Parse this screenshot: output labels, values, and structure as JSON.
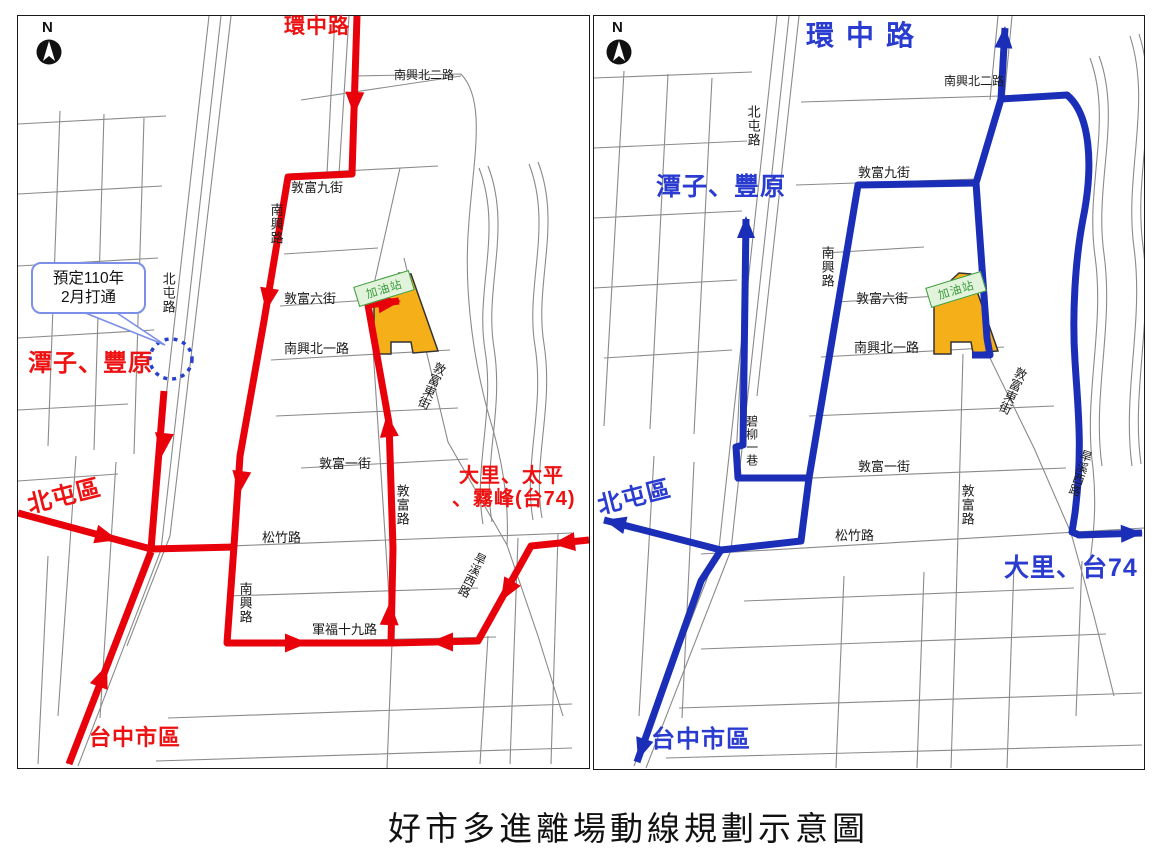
{
  "caption": "好市多進離場動線規劃示意圖",
  "compass_letter": "N",
  "callout": {
    "line1": "預定110年",
    "line2": "2月打通"
  },
  "gas_station_label": "加油站",
  "colors": {
    "entry_route": "#e8000b",
    "entry_text": "#ee1111",
    "exit_route": "#1b2eb8",
    "exit_text": "#2a3bd0",
    "site_fill": "#f5b019",
    "site_stroke": "#333333",
    "gas_fill": "#e2f3dc",
    "gas_stroke": "#3a9a3a",
    "callout_accent": "#7b8fe8",
    "dotted_circle": "#2741cd"
  },
  "left_map": {
    "street_labels": [
      {
        "t": "南興北二路",
        "x": 376,
        "y": 53,
        "fs": 12
      },
      {
        "t": "敦富九街",
        "x": 273,
        "y": 165,
        "fs": 13
      },
      {
        "t": "敦富六街",
        "x": 266,
        "y": 276,
        "fs": 13
      },
      {
        "t": "南興北一路",
        "x": 266,
        "y": 326,
        "fs": 13
      },
      {
        "t": "敦富一街",
        "x": 301,
        "y": 441,
        "fs": 13
      },
      {
        "t": "松竹路",
        "x": 244,
        "y": 515,
        "fs": 13
      },
      {
        "t": "軍福十九路",
        "x": 294,
        "y": 607,
        "fs": 13
      },
      {
        "t": "南興路",
        "x": 251,
        "y": 187,
        "fs": 13,
        "v": 1
      },
      {
        "t": "北屯路",
        "x": 143,
        "y": 256,
        "fs": 13,
        "v": 1
      },
      {
        "t": "敦富路",
        "x": 377,
        "y": 468,
        "fs": 13,
        "v": 1
      },
      {
        "t": "南興路",
        "x": 220,
        "y": 566,
        "fs": 13,
        "v": 1
      },
      {
        "t": "敦富東街",
        "x": 416,
        "y": 346,
        "fs": 12.5,
        "v": 1,
        "rot": 24
      },
      {
        "t": "旱溪西路",
        "x": 458,
        "y": 537,
        "fs": 12,
        "v": 1,
        "rot": 26
      }
    ],
    "region_labels": [
      {
        "t": "環中路",
        "x": 266,
        "y": 0,
        "fs": 21
      },
      {
        "t": "潭子、豐原",
        "x": 10,
        "y": 335,
        "fs": 24
      },
      {
        "t": "北屯區",
        "x": 9,
        "y": 468,
        "fs": 24,
        "rot": -14
      },
      {
        "t": "台中市區",
        "x": 71,
        "y": 710,
        "fs": 22
      },
      {
        "t": "大里、太平",
        "x": 441,
        "y": 450,
        "fs": 20
      },
      {
        "t": "、霧峰(台74)",
        "x": 434,
        "y": 473,
        "fs": 20
      }
    ],
    "routes": [
      {
        "d": "M339,0 L334,158 L270,161 L246,305 L222,440 L216,530 L209,627 L373,627 L375,532 L371,407 L350,289 L381,285",
        "arrows": [
          [
            336,
            99,
            92
          ],
          [
            248,
            295,
            99
          ],
          [
            221,
            478,
            97
          ],
          [
            290,
            627,
            0
          ],
          [
            372,
            586,
            -88
          ],
          [
            369,
            398,
            -96
          ],
          [
            383,
            285,
            -7
          ]
        ]
      },
      {
        "d": "M146,375 L133,533 L217,531",
        "arrows": [
          [
            144,
            440,
            96
          ]
        ]
      },
      {
        "d": "M0,497 L133,533",
        "arrows": [
          [
            100,
            524,
            15
          ]
        ]
      },
      {
        "d": "M51,748 L133,536",
        "arrows": [
          [
            89,
            649,
            -69
          ]
        ]
      },
      {
        "d": "M571,524 L513,530 L460,625 L374,627",
        "arrows": [
          [
            534,
            528,
            174
          ],
          [
            483,
            585,
            120
          ],
          [
            412,
            626,
            180
          ]
        ]
      }
    ]
  },
  "right_map": {
    "street_labels": [
      {
        "t": "南興北二路",
        "x": 350,
        "y": 59,
        "fs": 12
      },
      {
        "t": "敦富九街",
        "x": 264,
        "y": 150,
        "fs": 13
      },
      {
        "t": "敦富六街",
        "x": 262,
        "y": 276,
        "fs": 13
      },
      {
        "t": "南興北一路",
        "x": 260,
        "y": 325,
        "fs": 13
      },
      {
        "t": "敦富一街",
        "x": 264,
        "y": 444,
        "fs": 13
      },
      {
        "t": "松竹路",
        "x": 241,
        "y": 513,
        "fs": 13
      },
      {
        "t": "北屯路",
        "x": 152,
        "y": 89,
        "fs": 13,
        "v": 1
      },
      {
        "t": "南興路",
        "x": 226,
        "y": 230,
        "fs": 13,
        "v": 1
      },
      {
        "t": "碧柳一巷",
        "x": 151,
        "y": 399,
        "fs": 12,
        "v": 1
      },
      {
        "t": "敦富路",
        "x": 366,
        "y": 468,
        "fs": 13,
        "v": 1
      },
      {
        "t": "敦富東街",
        "x": 421,
        "y": 351,
        "fs": 12.5,
        "v": 1,
        "rot": 24
      },
      {
        "t": "旱溪西路",
        "x": 487,
        "y": 434,
        "fs": 12,
        "v": 1,
        "rot": 18
      }
    ],
    "region_labels": [
      {
        "t": "環中路",
        "x": 212,
        "y": 5,
        "fs": 28,
        "ls": 12
      },
      {
        "t": "潭子、豐原",
        "x": 62,
        "y": 158,
        "fs": 25
      },
      {
        "t": "北屯區",
        "x": 3,
        "y": 469,
        "fs": 24,
        "rot": -14
      },
      {
        "t": "大里、台74",
        "x": 410,
        "y": 539,
        "fs": 25
      },
      {
        "t": "台中市區",
        "x": 57,
        "y": 711,
        "fs": 24
      }
    ],
    "routes": [
      {
        "d": "M378,339 L396,339 L393,322 L382,167",
        "arrows": []
      },
      {
        "d": "M382,167 L264,169 L215,462 L144,462 L142,431 L149,429 L152,203",
        "arrows": [
          [
            152,
            200,
            -90
          ]
        ]
      },
      {
        "d": "M215,462 L207,525 L127,534 L10,504",
        "arrows": [
          [
            10,
            504,
            -166
          ]
        ]
      },
      {
        "d": "M127,534 L107,565 L43,746",
        "arrows": [
          [
            44,
            744,
            108
          ]
        ]
      },
      {
        "d": "M382,167 L407,83 L411,12",
        "arrows": [
          [
            411,
            10,
            -86
          ]
        ]
      },
      {
        "d": "M407,83 L473,79 C496,98 500,148 489,203 C481,245 478,300 481,345 C484,395 489,432 481,497 L478,516 L485,519 L548,517",
        "arrows": [
          [
            549,
            517,
            -2
          ]
        ]
      }
    ]
  }
}
